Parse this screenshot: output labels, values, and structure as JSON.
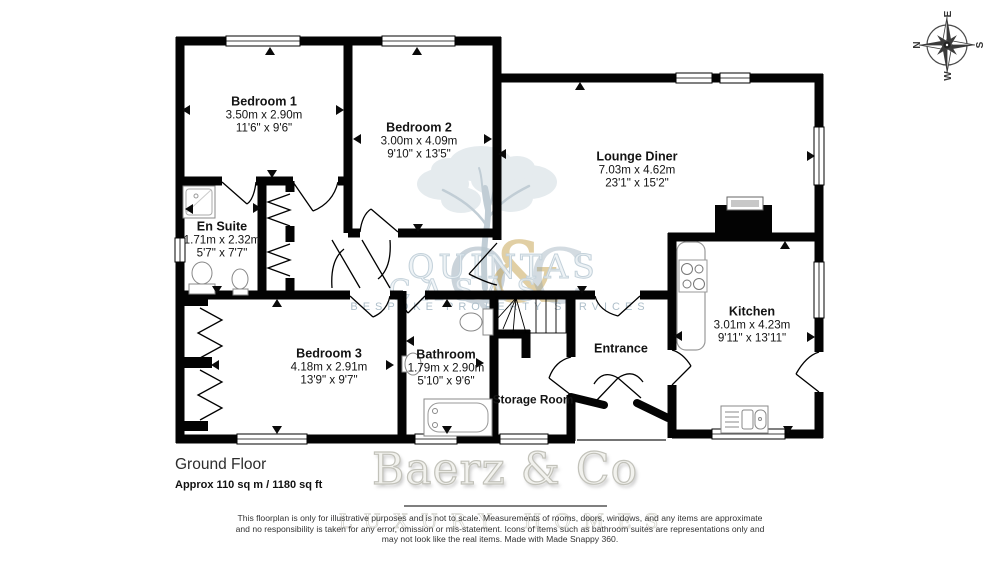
{
  "floor": {
    "label": "Ground Floor",
    "area": "Approx 110 sq m / 1180 sq ft"
  },
  "rooms": [
    {
      "name": "Bedroom 1",
      "metric": "3.50m x 2.90m",
      "imperial": "11'6\" x 9'6\""
    },
    {
      "name": "Bedroom 2",
      "metric": "3.00m x 4.09m",
      "imperial": "9'10\" x 13'5\""
    },
    {
      "name": "Lounge Diner",
      "metric": "7.03m x 4.62m",
      "imperial": "23'1\" x 15'2\""
    },
    {
      "name": "En Suite",
      "metric": "1.71m x 2.32m",
      "imperial": "5'7\" x 7'7\""
    },
    {
      "name": "Bedroom 3",
      "metric": "4.18m x 2.91m",
      "imperial": "13'9\" x 9'7\""
    },
    {
      "name": "Bathroom",
      "metric": "1.79m x 2.90m",
      "imperial": "5'10\" x 9'6\""
    },
    {
      "name": "Kitchen",
      "metric": "3.01m x 4.23m",
      "imperial": "9'11\" x 13'11\""
    },
    {
      "name": "Entrance",
      "metric": "",
      "imperial": ""
    },
    {
      "name": "Storage Room",
      "metric": "",
      "imperial": ""
    }
  ],
  "compass": {
    "n": "N",
    "e": "E",
    "s": "S",
    "w": "W"
  },
  "watermark": {
    "monogram_q": "Q",
    "monogram_amp": "&",
    "monogram_c": "C",
    "word_top": "QUINTAS",
    "word_bottom": "CASAS",
    "tagline": "BESPOKE PROPERTY SERVICES",
    "by": "by",
    "brand": "Baerz & Co",
    "brand_tagline": "LUXURY HOMES",
    "accent_gold": "#c9a84c",
    "tint_blue": "#ccd7de",
    "wall_color": "#030303"
  },
  "disclaimer": {
    "line1": "This floorplan is only for illustrative purposes and is not to scale. Measurements of rooms, doors, windows, and any items are approximate",
    "line2": "and no responsibility is taken for any error, omission or mis-statement. Icons of items such as bathroom suites are representations only and",
    "line3": "may not look like the real items. Made with Made Snappy 360."
  }
}
